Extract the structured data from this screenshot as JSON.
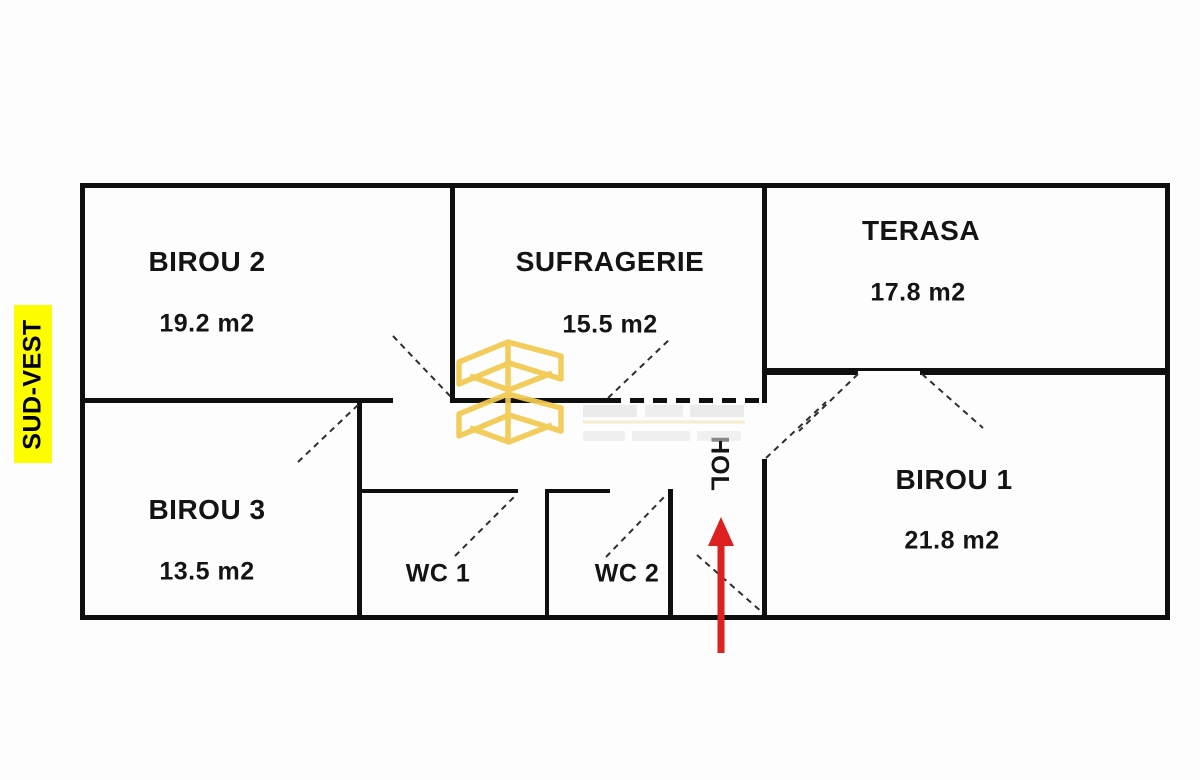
{
  "document": {
    "type": "floor-plan"
  },
  "orientation_label": {
    "text": "SUD-VEST",
    "bg_color": "#FDFD00",
    "text_color": "#141414"
  },
  "rooms": {
    "birou2": {
      "name": "BIROU 2",
      "area": "19.2 m2"
    },
    "sufragerie": {
      "name": "SUFRAGERIE",
      "area": "15.5 m2"
    },
    "terasa": {
      "name": "TERASA",
      "area": "17.8 m2"
    },
    "birou3": {
      "name": "BIROU 3",
      "area": "13.5 m2"
    },
    "wc1": {
      "name": "WC 1"
    },
    "wc2": {
      "name": "WC 2"
    },
    "hol": {
      "name": "HOL"
    },
    "birou1": {
      "name": "BIROU 1",
      "area": "21.8 m2"
    }
  },
  "colors": {
    "wall": "#0F0F0F",
    "door_dash": "#2E2E2E",
    "entrance_arrow": "#DD2020",
    "watermark_gold": "#F2CA4E",
    "highlight_yellow": "#FDFD00"
  }
}
